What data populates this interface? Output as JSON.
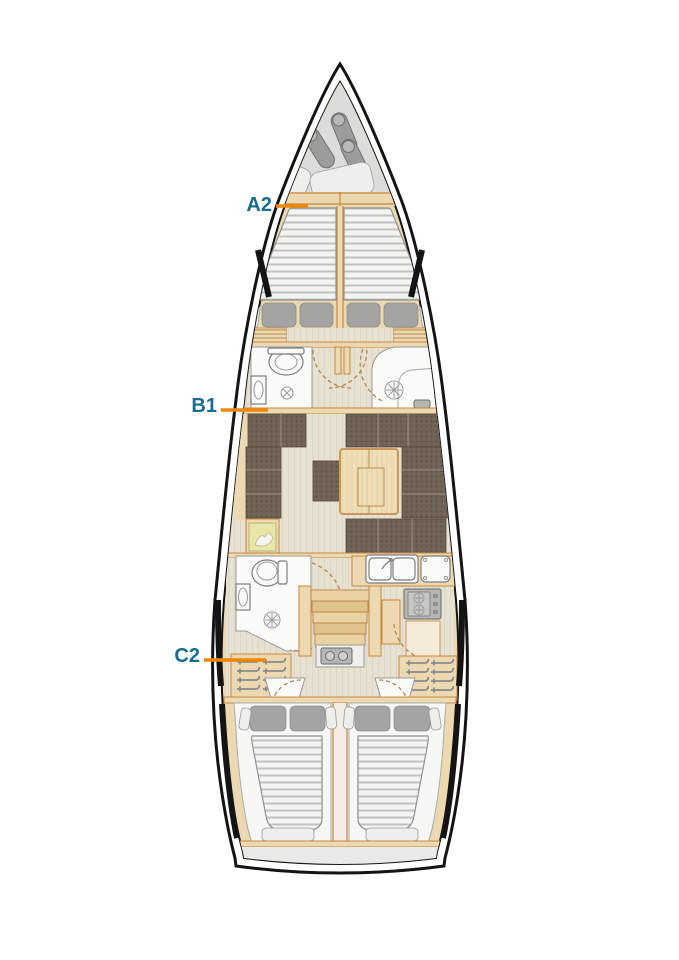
{
  "figure": {
    "type": "sailing-yacht-interior-layout-plan"
  },
  "labels": {
    "a2": "A2",
    "b1": "B1",
    "c2": "C2"
  },
  "colors": {
    "teal": "#176e8e",
    "orange": "#ed8708",
    "hull": "#141414",
    "trim": "#ecd9b2",
    "trim_line": "#c4883e",
    "floor": "#e7e1d2",
    "forepeak": "#dcdcda",
    "room": "#fbfbfa",
    "mattress": "#f4f4f2",
    "mattress_stripe": "#c2c2c0",
    "pillow": "#a4a4a2",
    "sofa": "#6f6356",
    "table": "#efdfb8",
    "appliance": "#b6b6b4",
    "chart": "#e9e7a8"
  },
  "icons": {
    "toilet-icon": "ellipse-bowl",
    "sink-icon": "basin-oval",
    "shower-drain-icon": "circle-with-spokes",
    "stove-icon": "gray-box-two-burners",
    "galley-sink-icon": "double-basin-with-faucet",
    "hanger-icon": "bar-with-hook",
    "door-swing-icon": "dashed-quarter-arc",
    "fender-icon": "gray-capsule",
    "sail-bag-icon": "white-rounded-bag",
    "engine-icon": "gray-block-two-caps",
    "chart-map-icon": "yellow-chart-with-figure"
  }
}
